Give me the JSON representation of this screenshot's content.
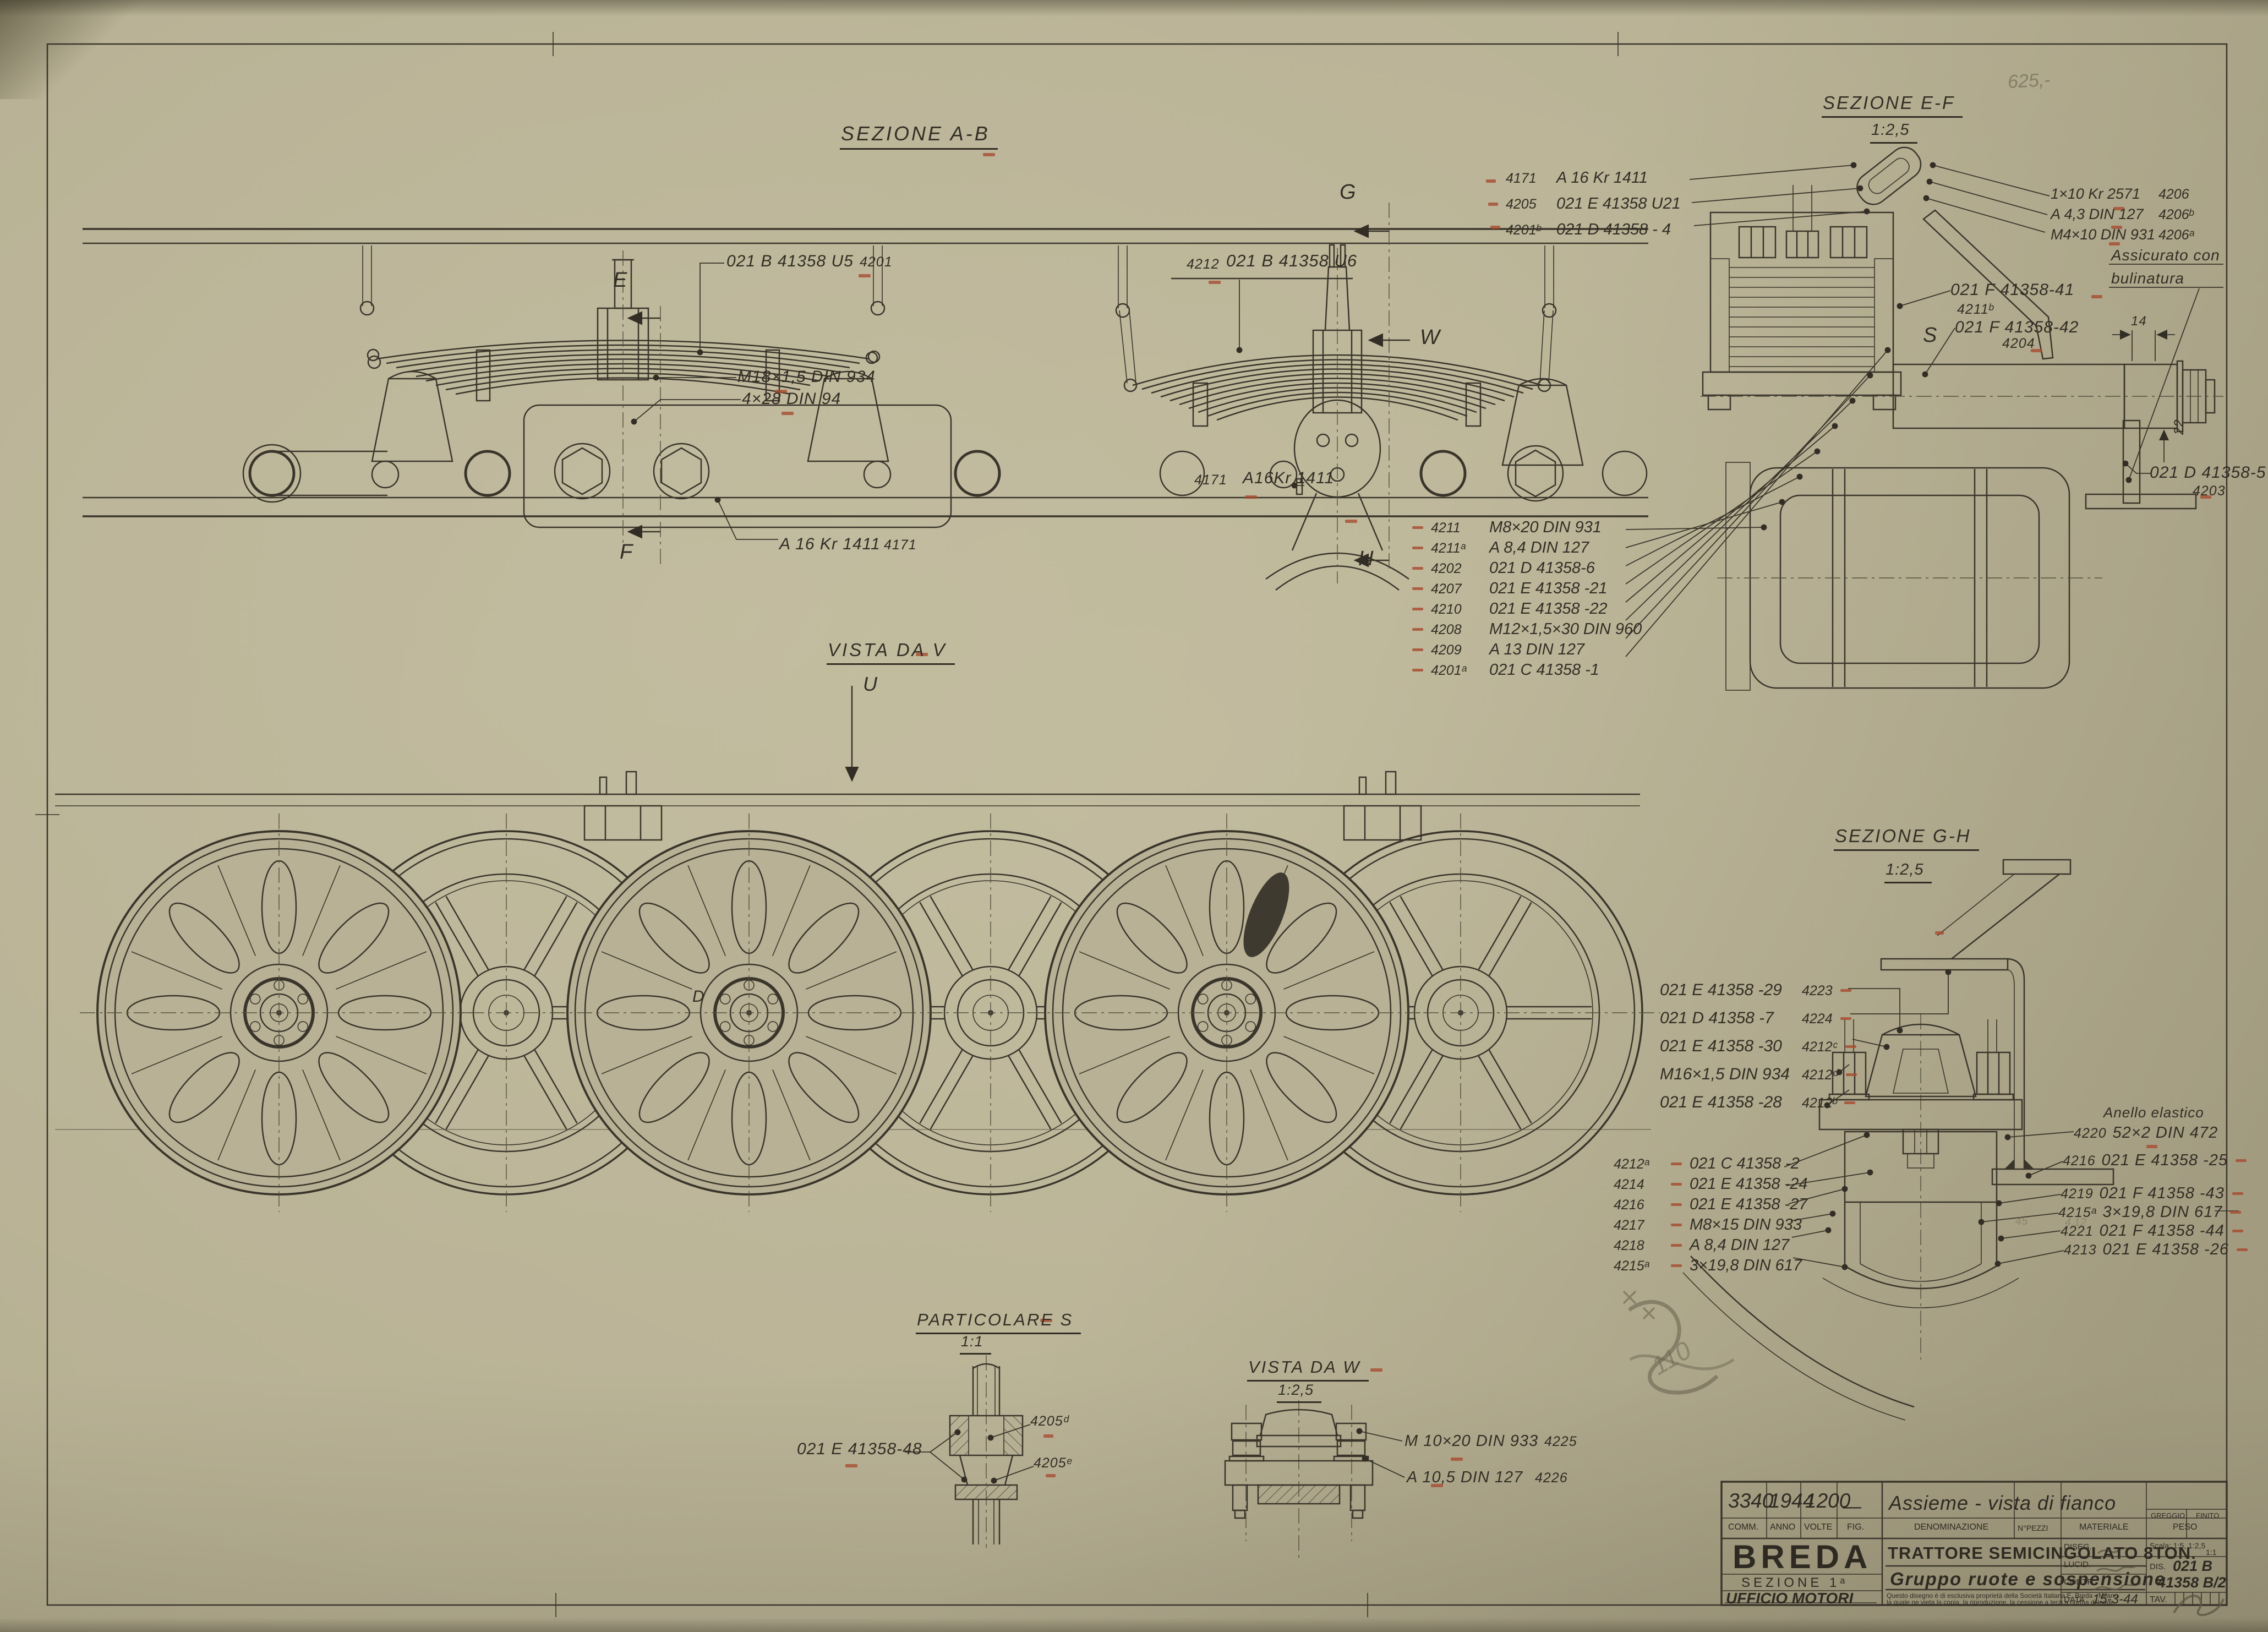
{
  "sheet": {
    "pencil_top": "625,-",
    "pencil_scribble": "110",
    "pencil_faint_a": "45",
    "pencil_faint_b": "4.12"
  },
  "titles": {
    "ab": "SEZIONE A-B",
    "ef": "SEZIONE E-F",
    "ef_scale": "1:2,5",
    "gh": "SEZIONE G-H",
    "gh_scale": "1:2,5",
    "vv": "VISTA DA V",
    "ps": "PARTICOLARE S",
    "ps_scale": "1:1",
    "vw": "VISTA DA W",
    "vw_scale": "1:2,5"
  },
  "letters": {
    "e": "E",
    "f": "F",
    "g": "G",
    "h": "H",
    "w": "W",
    "u": "U",
    "s": "S",
    "d": "D"
  },
  "ab": {
    "spring1_part": "021 B 41358 U5",
    "spring1_ref": "4201",
    "nut": "M18×1,5 DIN 934",
    "cotter": "4×28 DIN 94",
    "axle_part": "A 16 Kr 1411",
    "axle_ref": "4171",
    "spring2_ref": "4212",
    "spring2_part": "021 B 41358 U6",
    "pin2_ref": "4171",
    "pin2_part": "A16Kr 1411"
  },
  "ef_top_list": [
    {
      "ref": "4171",
      "part": "A 16 Kr 1411"
    },
    {
      "ref": "4205",
      "part": "021 E 41358 U21"
    },
    {
      "ref": "4201ᵇ",
      "part": "021 D 41358 - 4"
    }
  ],
  "ef_right_list": [
    {
      "part": "1×10 Kr 2571",
      "ref": "4206"
    },
    {
      "part": "A 4,3 DIN 127",
      "ref": "4206ᵇ"
    },
    {
      "part": "M4×10 DIN 931",
      "ref": "4206ᵃ"
    }
  ],
  "ef_note": {
    "l1": "Assicurato con",
    "l2": "bulinatura"
  },
  "ef_dim14": "14",
  "ef_dim22": "22",
  "ef_p41": {
    "part": "021 F 41358-41",
    "ref": "4211ᵇ"
  },
  "ef_p42": {
    "part": "021 F 41358-42",
    "ref": "4204"
  },
  "ef_p5": {
    "part": "021 D 41358-5",
    "ref": "4203"
  },
  "ef_bottom_list": [
    {
      "ref": "4211",
      "part": "M8×20 DIN 931"
    },
    {
      "ref": "4211ᵃ",
      "part": "A 8,4 DIN 127"
    },
    {
      "ref": "4202",
      "part": "021 D 41358-6"
    },
    {
      "ref": "4207",
      "part": "021 E 41358 -21"
    },
    {
      "ref": "4210",
      "part": "021 E 41358 -22"
    },
    {
      "ref": "4208",
      "part": "M12×1,5×30 DIN 960"
    },
    {
      "ref": "4209",
      "part": "A 13 DIN 127"
    },
    {
      "ref": "4201ᵃ",
      "part": "021 C 41358 -1"
    }
  ],
  "gh_top_list": [
    {
      "part": "021 E 41358 -29",
      "ref": "4223"
    },
    {
      "part": "021 D 41358 -7",
      "ref": "4224"
    },
    {
      "part": "021 E 41358 -30",
      "ref": "4212ᶜ"
    },
    {
      "part": "M16×1,5 DIN 934",
      "ref": "4212ᵈ"
    },
    {
      "part": "021 E 41358 -28",
      "ref": "4212ᵇ"
    }
  ],
  "gh_bottom_list": [
    {
      "ref": "4212ᵃ",
      "part": "021 C 41358 -2"
    },
    {
      "ref": "4214",
      "part": "021 E 41358 -24"
    },
    {
      "ref": "4216",
      "part": "021 E 41358 -27"
    },
    {
      "ref": "4217",
      "part": "M8×15 DIN 933"
    },
    {
      "ref": "4218",
      "part": "A 8,4 DIN 127"
    },
    {
      "ref": "4215ᵃ",
      "part": "3×19,8 DIN 617"
    }
  ],
  "gh_right": {
    "note": "Anello elastico",
    "rows": [
      {
        "ref": "4220",
        "part": "52×2 DIN 472"
      },
      {
        "ref": "4216",
        "part": "021 E 41358 -25"
      },
      {
        "ref": "4219",
        "part": "021 F 41358 -43"
      },
      {
        "ref": "4215ᵃ",
        "part": "3×19,8 DIN 617"
      },
      {
        "ref": "4221",
        "part": "021 F 41358 -44"
      },
      {
        "ref": "4213",
        "part": "021 E 41358 -26"
      }
    ]
  },
  "ps": {
    "part": "021 E 41358-48",
    "ref_d": "4205ᵈ",
    "ref_e": "4205ᵉ"
  },
  "vw_list": [
    {
      "part": "M 10×20 DIN 933",
      "ref": "4225"
    },
    {
      "part": "A 10,5 DIN 127",
      "ref": "4226"
    }
  ],
  "title_block": {
    "comm_value": "3340",
    "anno_value": "1944",
    "volte_value": "1200",
    "fig_value": "—",
    "denominazione_value": "Assieme - vista di fianco",
    "greggio": "GREGGIO",
    "finito": "FINITO",
    "comm": "COMM.",
    "anno": "ANNO",
    "volte": "VOLTE",
    "fig": "FIG.",
    "denominazione": "DENOMINAZIONE",
    "npezzi": "N°PEZZI",
    "materiale": "MATERIALE",
    "peso": "PESO",
    "company": "BREDA",
    "sezione": "SEZIONE 1ᵃ",
    "ufficio": "UFFICIO MOTORI",
    "line1": "TRATTORE SEMICINGOLATO 8TON.",
    "line2": "Gruppo ruote e sospensione",
    "diseg": "DISEG.",
    "lucid": "LUCID.",
    "contr": "CONTR.",
    "data": "DATA",
    "data_value": "15-3-44",
    "scala": "Scala: 1:5, 1:2,5",
    "scala2": "1:1",
    "dis": "DIS.",
    "dis_value1": "021 B",
    "dis_value2": "41358 B/2",
    "tav": "TAV.",
    "note1": "Questo disegno è di esclusiva proprietà della Società Italiana E. Breda - Milano",
    "note2": "la quale ne vieta la copia, la riproduzione, la cessione a terzi a norma di legge."
  }
}
